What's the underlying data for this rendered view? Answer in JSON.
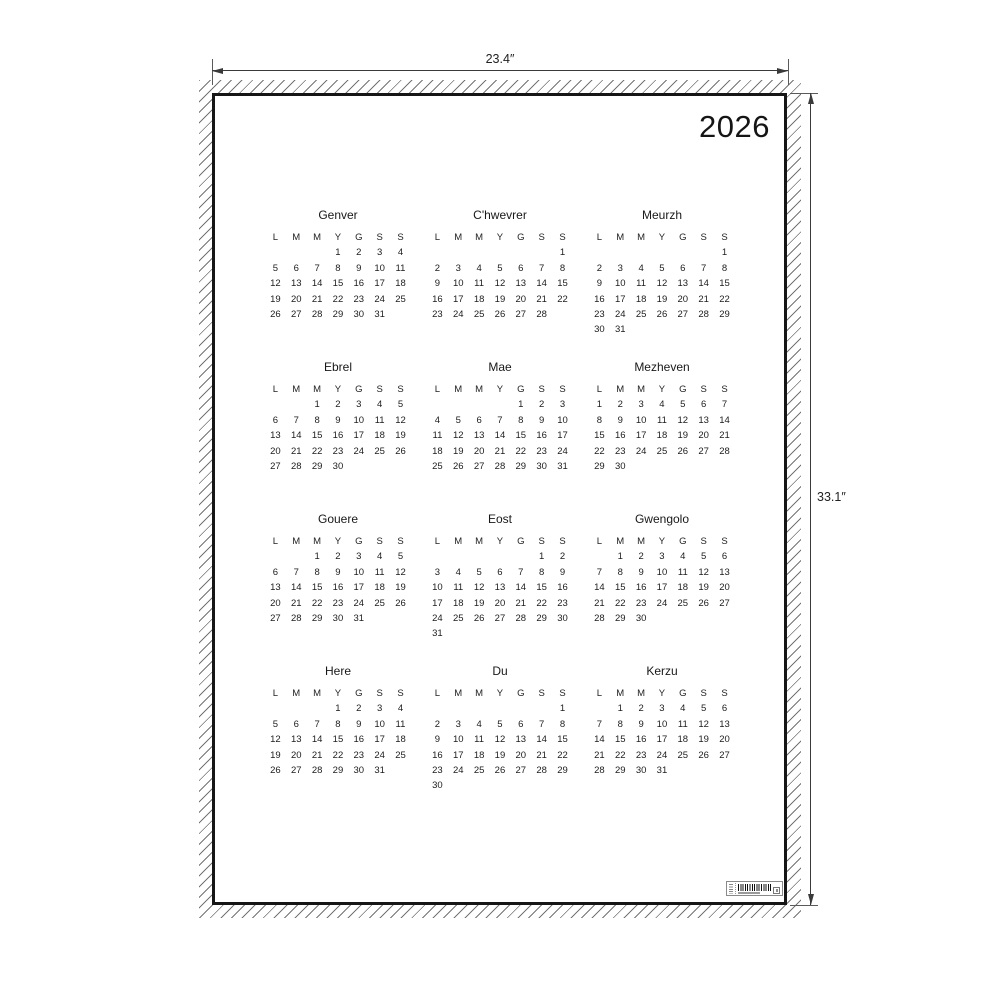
{
  "dimensions_annotation": {
    "width_label": "23.4″",
    "height_label": "33.1″"
  },
  "poster": {
    "year": "2026",
    "weekday_headers": [
      "L",
      "M",
      "M",
      "Y",
      "G",
      "S",
      "S"
    ],
    "months": [
      {
        "name": "Genver",
        "weeks": [
          [
            "",
            "",
            "",
            "1",
            "2",
            "3",
            "4"
          ],
          [
            "5",
            "6",
            "7",
            "8",
            "9",
            "10",
            "11"
          ],
          [
            "12",
            "13",
            "14",
            "15",
            "16",
            "17",
            "18"
          ],
          [
            "19",
            "20",
            "21",
            "22",
            "23",
            "24",
            "25"
          ],
          [
            "26",
            "27",
            "28",
            "29",
            "30",
            "31",
            ""
          ]
        ]
      },
      {
        "name": "C'hwevrer",
        "weeks": [
          [
            "",
            "",
            "",
            "",
            "",
            "",
            "1"
          ],
          [
            "2",
            "3",
            "4",
            "5",
            "6",
            "7",
            "8"
          ],
          [
            "9",
            "10",
            "11",
            "12",
            "13",
            "14",
            "15"
          ],
          [
            "16",
            "17",
            "18",
            "19",
            "20",
            "21",
            "22"
          ],
          [
            "23",
            "24",
            "25",
            "26",
            "27",
            "28",
            ""
          ]
        ]
      },
      {
        "name": "Meurzh",
        "weeks": [
          [
            "",
            "",
            "",
            "",
            "",
            "",
            "1"
          ],
          [
            "2",
            "3",
            "4",
            "5",
            "6",
            "7",
            "8"
          ],
          [
            "9",
            "10",
            "11",
            "12",
            "13",
            "14",
            "15"
          ],
          [
            "16",
            "17",
            "18",
            "19",
            "20",
            "21",
            "22"
          ],
          [
            "23",
            "24",
            "25",
            "26",
            "27",
            "28",
            "29"
          ],
          [
            "30",
            "31",
            "",
            "",
            "",
            "",
            ""
          ]
        ]
      },
      {
        "name": "Ebrel",
        "weeks": [
          [
            "",
            "",
            "1",
            "2",
            "3",
            "4",
            "5"
          ],
          [
            "6",
            "7",
            "8",
            "9",
            "10",
            "11",
            "12"
          ],
          [
            "13",
            "14",
            "15",
            "16",
            "17",
            "18",
            "19"
          ],
          [
            "20",
            "21",
            "22",
            "23",
            "24",
            "25",
            "26"
          ],
          [
            "27",
            "28",
            "29",
            "30",
            "",
            "",
            ""
          ]
        ]
      },
      {
        "name": "Mae",
        "weeks": [
          [
            "",
            "",
            "",
            "",
            "1",
            "2",
            "3"
          ],
          [
            "4",
            "5",
            "6",
            "7",
            "8",
            "9",
            "10"
          ],
          [
            "11",
            "12",
            "13",
            "14",
            "15",
            "16",
            "17"
          ],
          [
            "18",
            "19",
            "20",
            "21",
            "22",
            "23",
            "24"
          ],
          [
            "25",
            "26",
            "27",
            "28",
            "29",
            "30",
            "31"
          ]
        ]
      },
      {
        "name": "Mezheven",
        "weeks": [
          [
            "1",
            "2",
            "3",
            "4",
            "5",
            "6",
            "7"
          ],
          [
            "8",
            "9",
            "10",
            "11",
            "12",
            "13",
            "14"
          ],
          [
            "15",
            "16",
            "17",
            "18",
            "19",
            "20",
            "21"
          ],
          [
            "22",
            "23",
            "24",
            "25",
            "26",
            "27",
            "28"
          ],
          [
            "29",
            "30",
            "",
            "",
            "",
            "",
            ""
          ]
        ]
      },
      {
        "name": "Gouere",
        "weeks": [
          [
            "",
            "",
            "1",
            "2",
            "3",
            "4",
            "5"
          ],
          [
            "6",
            "7",
            "8",
            "9",
            "10",
            "11",
            "12"
          ],
          [
            "13",
            "14",
            "15",
            "16",
            "17",
            "18",
            "19"
          ],
          [
            "20",
            "21",
            "22",
            "23",
            "24",
            "25",
            "26"
          ],
          [
            "27",
            "28",
            "29",
            "30",
            "31",
            "",
            ""
          ]
        ]
      },
      {
        "name": "Eost",
        "weeks": [
          [
            "",
            "",
            "",
            "",
            "",
            "1",
            "2"
          ],
          [
            "3",
            "4",
            "5",
            "6",
            "7",
            "8",
            "9"
          ],
          [
            "10",
            "11",
            "12",
            "13",
            "14",
            "15",
            "16"
          ],
          [
            "17",
            "18",
            "19",
            "20",
            "21",
            "22",
            "23"
          ],
          [
            "24",
            "25",
            "26",
            "27",
            "28",
            "29",
            "30"
          ],
          [
            "31",
            "",
            "",
            "",
            "",
            "",
            ""
          ]
        ]
      },
      {
        "name": "Gwengolo",
        "weeks": [
          [
            "",
            "1",
            "2",
            "3",
            "4",
            "5",
            "6"
          ],
          [
            "7",
            "8",
            "9",
            "10",
            "11",
            "12",
            "13"
          ],
          [
            "14",
            "15",
            "16",
            "17",
            "18",
            "19",
            "20"
          ],
          [
            "21",
            "22",
            "23",
            "24",
            "25",
            "26",
            "27"
          ],
          [
            "28",
            "29",
            "30",
            "",
            "",
            "",
            ""
          ]
        ]
      },
      {
        "name": "Here",
        "weeks": [
          [
            "",
            "",
            "",
            "1",
            "2",
            "3",
            "4"
          ],
          [
            "5",
            "6",
            "7",
            "8",
            "9",
            "10",
            "11"
          ],
          [
            "12",
            "13",
            "14",
            "15",
            "16",
            "17",
            "18"
          ],
          [
            "19",
            "20",
            "21",
            "22",
            "23",
            "24",
            "25"
          ],
          [
            "26",
            "27",
            "28",
            "29",
            "30",
            "31",
            ""
          ]
        ]
      },
      {
        "name": "Du",
        "weeks": [
          [
            "",
            "",
            "",
            "",
            "",
            "",
            "1"
          ],
          [
            "2",
            "3",
            "4",
            "5",
            "6",
            "7",
            "8"
          ],
          [
            "9",
            "10",
            "11",
            "12",
            "13",
            "14",
            "15"
          ],
          [
            "16",
            "17",
            "18",
            "19",
            "20",
            "21",
            "22"
          ],
          [
            "23",
            "24",
            "25",
            "26",
            "27",
            "28",
            "29"
          ],
          [
            "30",
            "",
            "",
            "",
            "",
            "",
            ""
          ]
        ]
      },
      {
        "name": "Kerzu",
        "weeks": [
          [
            "",
            "1",
            "2",
            "3",
            "4",
            "5",
            "6"
          ],
          [
            "7",
            "8",
            "9",
            "10",
            "11",
            "12",
            "13"
          ],
          [
            "14",
            "15",
            "16",
            "17",
            "18",
            "19",
            "20"
          ],
          [
            "21",
            "22",
            "23",
            "24",
            "25",
            "26",
            "27"
          ],
          [
            "28",
            "29",
            "30",
            "31",
            "",
            "",
            ""
          ]
        ]
      }
    ]
  },
  "icons": {
    "barcode": "barcode-label"
  },
  "colors": {
    "background": "#ffffff",
    "poster_border": "#161616",
    "text": "#1c1c1c",
    "dimension_line": "#3a3a3a",
    "hatch": "#464646"
  }
}
